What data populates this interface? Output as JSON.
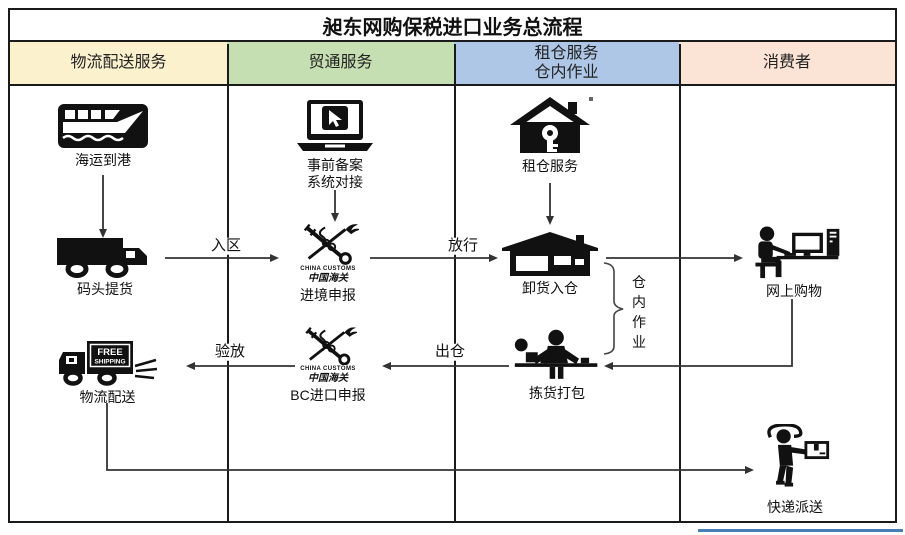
{
  "title": "昶东网购保税进口业务总流程",
  "columns": [
    {
      "label": "物流配送服务",
      "bg": "#FBF1CD"
    },
    {
      "label": "贸通服务",
      "bg": "#C5DEB2"
    },
    {
      "label": "租仓服务\n仓内作业",
      "bg": "#AFC7E7"
    },
    {
      "label": "消费者",
      "bg": "#FBE3D5"
    }
  ],
  "nodes": {
    "sea_arrival": {
      "label": "海运到港",
      "icon": "ship-icon"
    },
    "dock_pickup": {
      "label": "码头提货",
      "icon": "truck-icon"
    },
    "logistics_delivery": {
      "label": "物流配送",
      "icon": "free-shipping-truck-icon",
      "icon_text": {
        "line1": "FREE",
        "line2": "SHIPPING"
      }
    },
    "pre_filing": {
      "label_line1": "事前备案",
      "label_line2": "系统对接",
      "icon": "laptop-cursor-icon"
    },
    "entry_declaration": {
      "label": "进境申报",
      "icon": "china-customs-emblem",
      "emblem_en": "CHINA CUSTOMS",
      "emblem_cn": "中国海关"
    },
    "bc_import_declaration": {
      "label": "BC进口申报",
      "icon": "china-customs-emblem",
      "emblem_en": "CHINA CUSTOMS",
      "emblem_cn": "中国海关"
    },
    "warehouse_rental": {
      "label": "租仓服务",
      "icon": "house-key-icon"
    },
    "unload_into_warehouse": {
      "label": "卸货入仓",
      "icon": "warehouse-icon"
    },
    "pick_and_pack": {
      "label": "拣货打包",
      "icon": "packing-station-icon"
    },
    "online_shopping": {
      "label": "网上购物",
      "icon": "computer-user-icon"
    },
    "courier_delivery": {
      "label": "快递派送",
      "icon": "courier-icon"
    }
  },
  "edge_labels": {
    "enter_zone": "入区",
    "release": "放行",
    "out_of_warehouse": "出仓",
    "inspect_release": "验放",
    "in_warehouse_ops": "仓内作业"
  },
  "colors": {
    "border": "#1a1a1a",
    "connector": "#333333",
    "accent_underline": "#4A7EBB"
  }
}
